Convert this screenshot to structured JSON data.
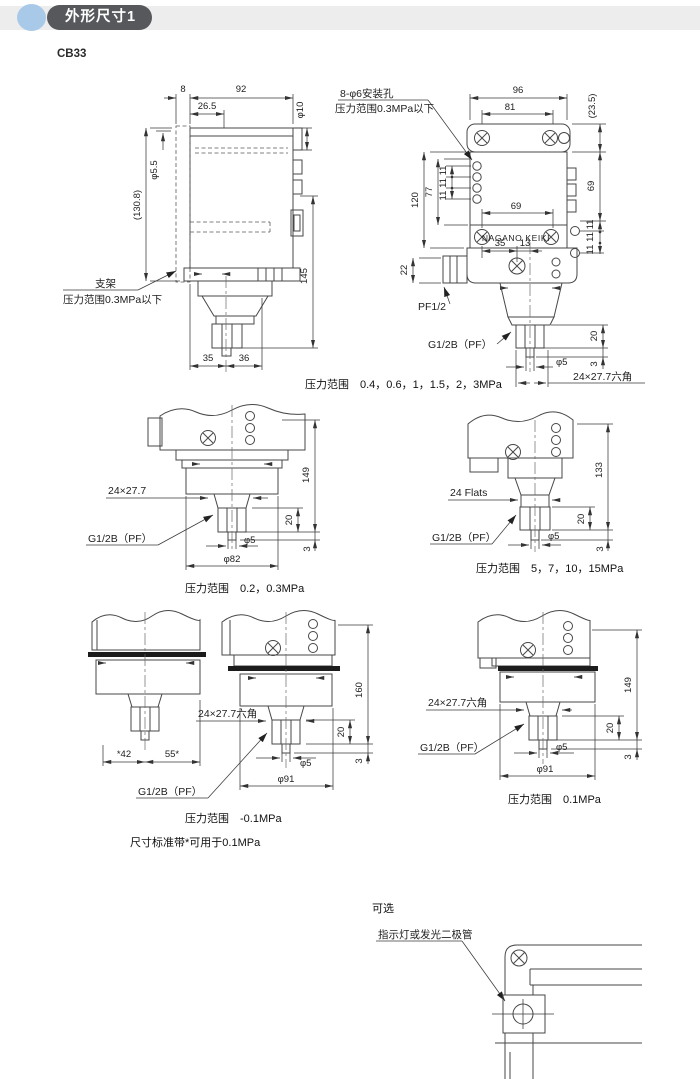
{
  "header": {
    "section_title": "外形尺寸1",
    "model": "CB33"
  },
  "colors": {
    "badge_bg": "#56585b",
    "bullet": "#a9c9e8",
    "band_bg": "#ededed",
    "line": "#474747"
  },
  "common": {
    "g12b": "G1/2B（PF）",
    "hex": "24×27.7六角",
    "pitch": "11 11 11",
    "h20": "20",
    "h3": "3",
    "phi5": "φ5",
    "h149": "149",
    "phi91": "φ91",
    "note03": "压力范围0.3MPa以下"
  },
  "sv": {
    "w8": "8",
    "w92": "92",
    "w265": "26.5",
    "phi10": "φ10",
    "phi55": "φ5.5",
    "h1308": "(130.8)",
    "h145": "145",
    "w35": "35",
    "w36": "36",
    "bracket": "支架"
  },
  "fv": {
    "holes": "8-φ6安装孔",
    "w96": "96",
    "w81": "81",
    "h235": "(23.5)",
    "h120": "120",
    "h77": "77",
    "w69": "69",
    "h69": "69",
    "w35": "35",
    "w13": "13",
    "h22": "22",
    "pf": "PF1/2",
    "brand": "NAGANO KEIKI",
    "caption": "压力范围　0.4，0.6，1，1.5，2，3MPa"
  },
  "v23": {
    "hex": "24×27.7",
    "phi82": "φ82",
    "caption": "压力范围　0.2，0.3MPa"
  },
  "v515": {
    "flats": "24 Flats",
    "h133": "133",
    "caption": "压力范围　5，7，10，15MPa"
  },
  "vn01": {
    "w42": "*42",
    "w55": "55*",
    "h160": "160",
    "caption": "压力范围　-0.1MPa",
    "note": "尺寸标准带*可用于0.1MPa"
  },
  "v01": {
    "caption": "压力范围　0.1MPa"
  },
  "opt": {
    "title": "可选",
    "label": "指示灯或发光二极管"
  }
}
